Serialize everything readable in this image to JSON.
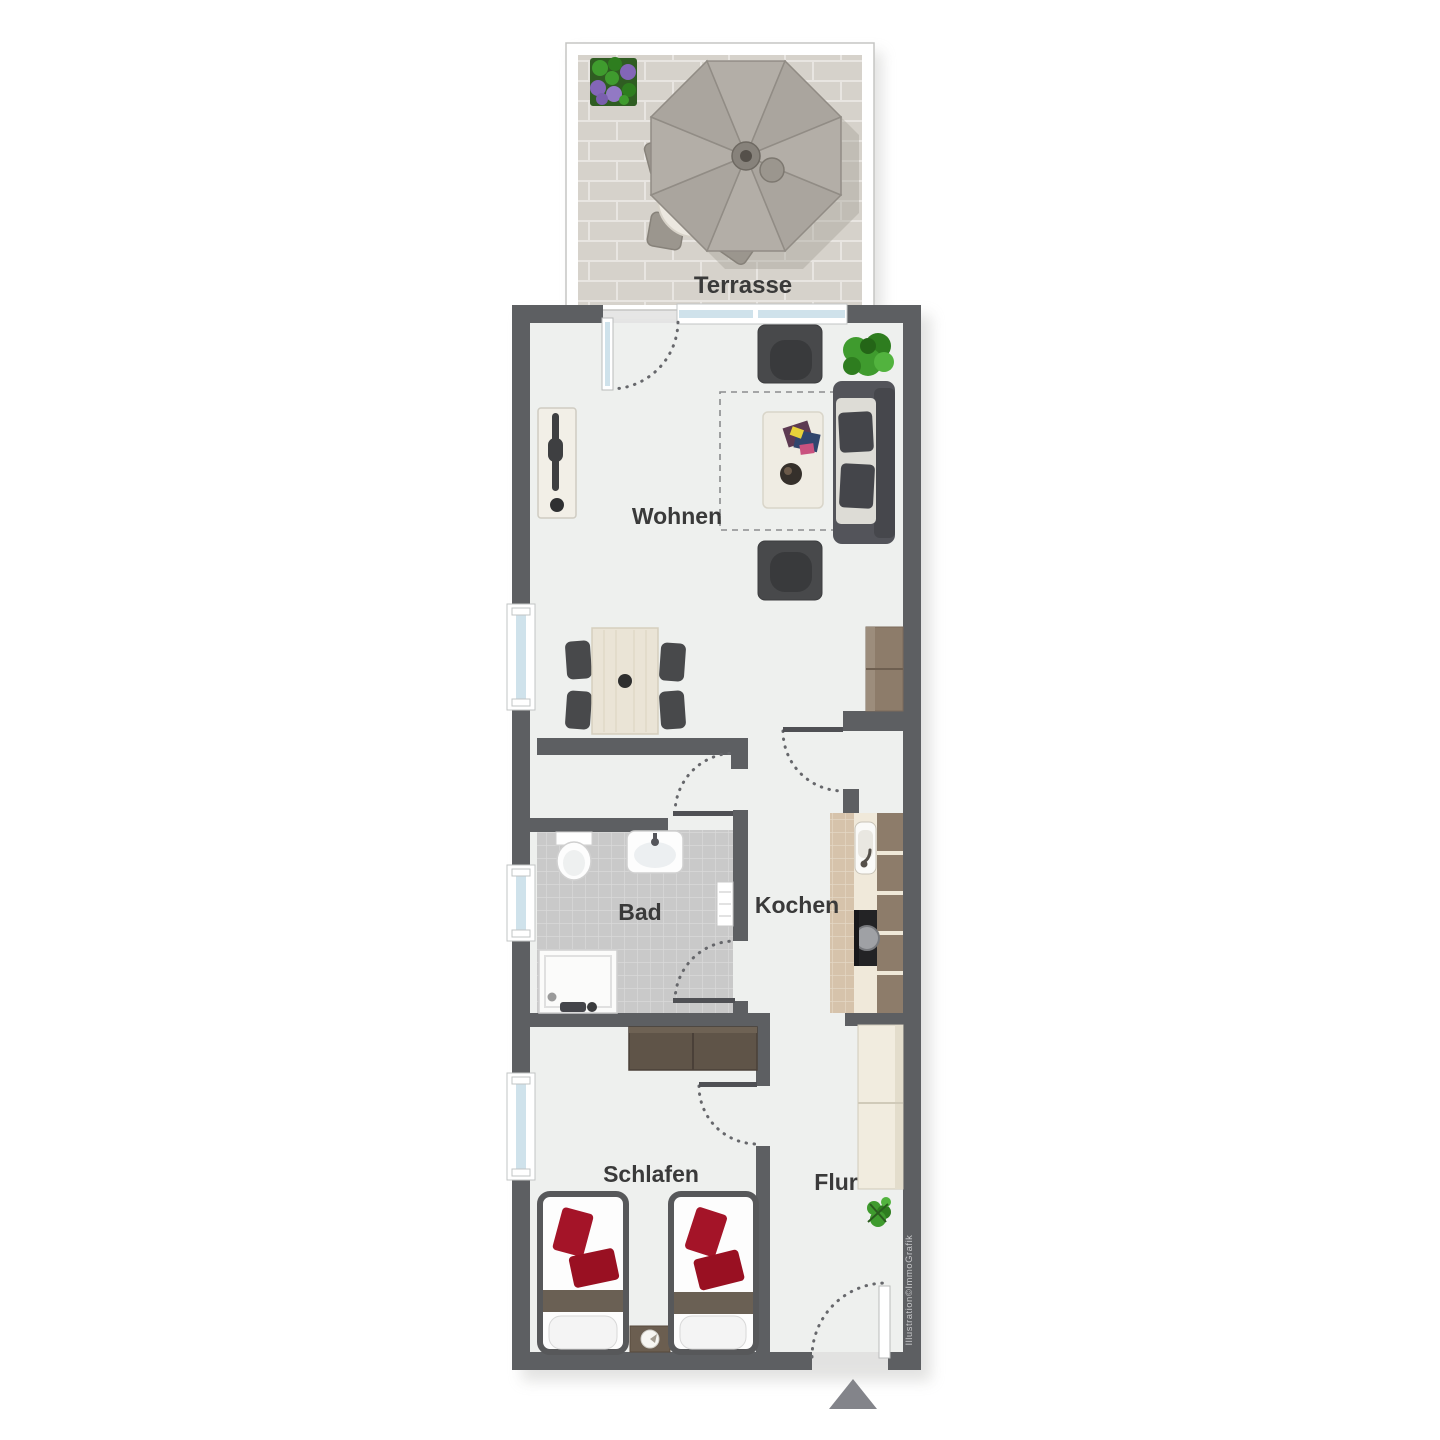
{
  "title": "Apartment floor plan",
  "labels": {
    "terrasse": "Terrasse",
    "wohnen": "Wohnen",
    "bad": "Bad",
    "kochen": "Kochen",
    "schlafen": "Schlafen",
    "flur": "Flur"
  },
  "watermark": "Illustration©ImmoGrafik",
  "colors": {
    "wall": "#5d5f62",
    "floor": "#eef0ee",
    "arc": "#66676b",
    "glass": "#cfe2eb",
    "label": "#3a3a3a",
    "dark": "#48494b",
    "red": "#a41428",
    "green": "#3f9b2e",
    "paving": "#d6d2cb",
    "paving_joint": "#e8e5e1",
    "bath_tile": "#c9c9c9",
    "bath_tile_joint": "#d9d9d9",
    "kitchen_beige": "#d6c3ab",
    "kitchen_brown": "#8d7c6a",
    "wood_light": "#eae4d6",
    "dresser_brown": "#5f5448",
    "arrow": "#83848a"
  }
}
